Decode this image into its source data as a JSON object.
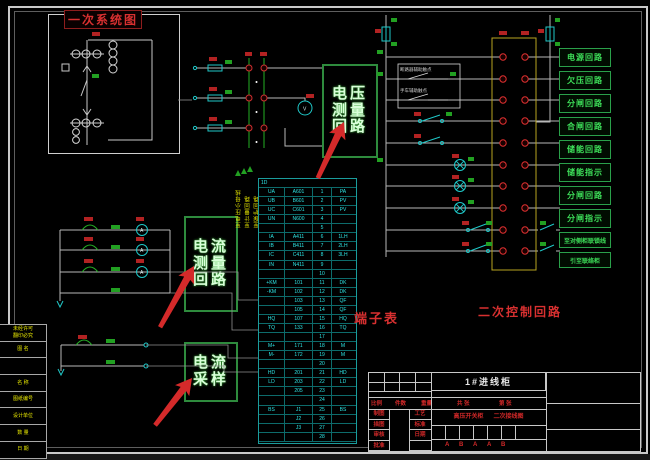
{
  "colors": {
    "background": "#000000",
    "frame": "#c9c9c9",
    "wire_green": "#25b025",
    "wire_cyan": "#1fc8c8",
    "annotation_red": "#d83030",
    "tag_yellow": "#e8e800",
    "terminal_red": "#e03030"
  },
  "annotations": {
    "primary_diagram_label": "一次系统图",
    "voltage_box_lines": [
      "电压",
      "测量",
      "回路"
    ],
    "current_box_lines": [
      "电流",
      "测量",
      "回路"
    ],
    "sampling_box_lines": [
      "电流",
      "采样"
    ],
    "terminal_table_label": "端子表",
    "secondary_circuit_label": "二次控制回路"
  },
  "symbols": {
    "ammeter": "A",
    "voltmeter": "V"
  },
  "relay_box": {
    "labels": [
      "断路器辅助触点",
      "手车辅助触点"
    ]
  },
  "circuit_boxes": [
    "电源回路",
    "欠压回路",
    "分闸回路",
    "合闸回路",
    "储能回路",
    "储能指示",
    "分闸回路",
    "分闸指示",
    "至对侧柜联锁线",
    "引至联络柜"
  ],
  "wire_tags": [
    "至电压小母线",
    "至计量回路",
    "至保护回路"
  ],
  "terminal_table": {
    "header": "1D",
    "rows": [
      [
        "UA",
        "A601",
        "1",
        "PA"
      ],
      [
        "UB",
        "B601",
        "2",
        "PV"
      ],
      [
        "UC",
        "C601",
        "3",
        "PV"
      ],
      [
        "UN",
        "N600",
        "4",
        ""
      ],
      [
        "",
        "",
        "5",
        ""
      ],
      [
        "IA",
        "A411",
        "6",
        "1LH"
      ],
      [
        "IB",
        "B411",
        "7",
        "2LH"
      ],
      [
        "IC",
        "C411",
        "8",
        "3LH"
      ],
      [
        "IN",
        "N411",
        "9",
        ""
      ],
      [
        "",
        "",
        "10",
        ""
      ],
      [
        "+KM",
        "101",
        "11",
        "DK"
      ],
      [
        "-KM",
        "102",
        "12",
        "DK"
      ],
      [
        "",
        "103",
        "13",
        "QF"
      ],
      [
        "",
        "105",
        "14",
        "QF"
      ],
      [
        "HQ",
        "107",
        "15",
        "HQ"
      ],
      [
        "TQ",
        "133",
        "16",
        "TQ"
      ],
      [
        "",
        "",
        "17",
        ""
      ],
      [
        "M+",
        "171",
        "18",
        "M"
      ],
      [
        "M-",
        "172",
        "19",
        "M"
      ],
      [
        "",
        "",
        "20",
        ""
      ],
      [
        "HD",
        "201",
        "21",
        "HD"
      ],
      [
        "LD",
        "203",
        "22",
        "LD"
      ],
      [
        "",
        "205",
        "23",
        ""
      ],
      [
        "",
        "",
        "24",
        ""
      ],
      [
        "BS",
        "J1",
        "25",
        "BS"
      ],
      [
        "",
        "J2",
        "26",
        ""
      ],
      [
        "",
        "J3",
        "27",
        ""
      ],
      [
        "",
        "",
        "28",
        ""
      ]
    ]
  },
  "left_table": {
    "rows": [
      "未经许可\n翻印必究",
      "图 名",
      "",
      "名 称",
      "图纸编号",
      "设计单位",
      "数 量",
      "日 期"
    ]
  },
  "title_block": {
    "cabinet": "1#进线柜",
    "info_row": [
      "比例",
      "件数",
      "重量",
      "共 张",
      "第 张"
    ],
    "left_col": [
      "制图",
      "描图",
      "审核",
      "批准"
    ],
    "mid_col": [
      "工艺",
      "标准",
      "日期",
      ""
    ],
    "center_row": [
      "高压开关柜",
      "二次接线图"
    ],
    "rev_letters": [
      "A",
      "B",
      "A",
      "A",
      "B"
    ]
  }
}
